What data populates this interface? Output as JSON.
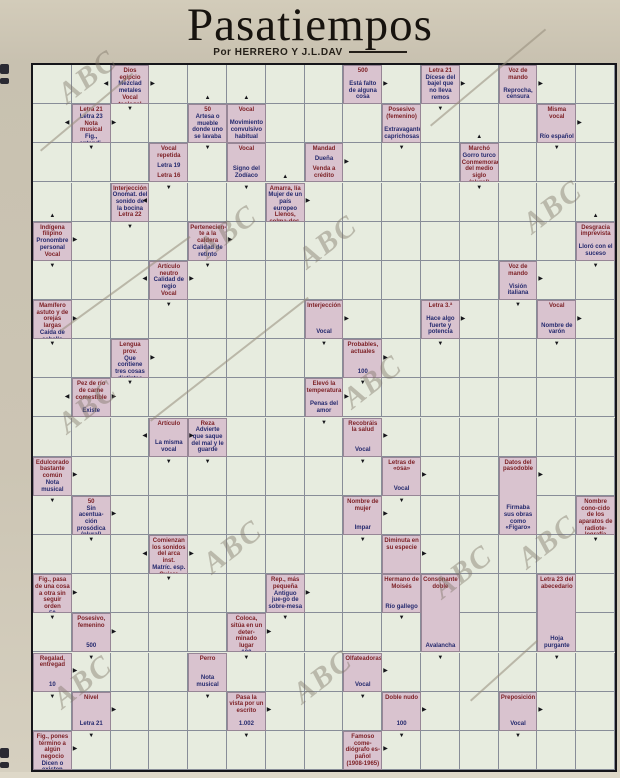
{
  "page": {
    "title": "Pasatiempos",
    "byline": "Por HERRERO Y J.L.DAV",
    "watermark_text": "ABC"
  },
  "colors": {
    "paper": "#cbc3b2",
    "board_bg": "#e7ecdf",
    "clue_bg": "#d9c3cf",
    "grid_line": "#3a405c",
    "clue_text_red": "#7c1f24",
    "clue_text_navy": "#252a6e",
    "arrow": "#15151a"
  },
  "grid": {
    "cols": 15,
    "rows": 18
  },
  "clues": [
    {
      "r": 0,
      "c": 2,
      "rs": 1,
      "text": "Dios egipcio|Mezclad metales|Vocal teologal"
    },
    {
      "r": 0,
      "c": 8,
      "rs": 1,
      "text": "500|Está falto de alguna cosa"
    },
    {
      "r": 0,
      "c": 10,
      "rs": 1,
      "text": "Letra 21|Dícese del bajel que no lleva remos"
    },
    {
      "r": 0,
      "c": 12,
      "rs": 1,
      "text": "Voz de mando|Reprocha, censura"
    },
    {
      "r": 1,
      "c": 1,
      "rs": 1,
      "text": "Letra 21|Letra 23|Nota musical|Fig., entendi-miento, seso"
    },
    {
      "r": 1,
      "c": 4,
      "rs": 1,
      "text": "50|Artesa o mueble donde uno se lavaba"
    },
    {
      "r": 1,
      "c": 5,
      "rs": 1,
      "text": "Vocal|Movimiento convulsivo habitual"
    },
    {
      "r": 1,
      "c": 9,
      "rs": 1,
      "text": "Posesivo (femenino)|Extravagantes, caprichosas"
    },
    {
      "r": 1,
      "c": 13,
      "rs": 1,
      "text": "Misma vocal|Río español"
    },
    {
      "r": 2,
      "c": 3,
      "rs": 1,
      "text": "Vocal repetida|Letra 19|Letra 16"
    },
    {
      "r": 2,
      "c": 5,
      "rs": 1,
      "text": "Vocal|Signo del Zodíaco"
    },
    {
      "r": 2,
      "c": 7,
      "rs": 1,
      "text": "Mandad|Dueña|Venda a crédito"
    },
    {
      "r": 2,
      "c": 11,
      "rs": 1,
      "text": "Marchó|Gorro turco|Conmemoración del medio siglo (plural)"
    },
    {
      "r": 3,
      "c": 2,
      "rs": 1,
      "text": "Interjección|Onomat. del sonido de la bocina|Letra 22"
    },
    {
      "r": 3,
      "c": 6,
      "rs": 1,
      "text": "Amarra, lía|Mujer de un país europeo|Llenos, colma-dos, totales"
    },
    {
      "r": 4,
      "c": 0,
      "rs": 1,
      "text": "Indígena filipino|Pronombre personal|Vocal"
    },
    {
      "r": 4,
      "c": 4,
      "rs": 1,
      "text": "Pertenecien-te a la caldera|Calidad de retinto"
    },
    {
      "r": 4,
      "c": 14,
      "rs": 1,
      "text": "Desgracia imprevista|Lloró con el suceso"
    },
    {
      "r": 5,
      "c": 3,
      "rs": 1,
      "text": "Artículo neutro|Calidad de regio|Vocal"
    },
    {
      "r": 5,
      "c": 12,
      "rs": 1,
      "text": "Voz de mando|Visión italiana"
    },
    {
      "r": 6,
      "c": 0,
      "rs": 1,
      "text": "Mamífero astuto y de orejas largas|Caída de cabello"
    },
    {
      "r": 6,
      "c": 7,
      "rs": 1,
      "text": "Interjección|Vocal"
    },
    {
      "r": 6,
      "c": 10,
      "rs": 1,
      "text": "Letra 3.ª|Hace algo fuerte y potencia"
    },
    {
      "r": 6,
      "c": 13,
      "rs": 1,
      "text": "Vocal|Nombre de varón"
    },
    {
      "r": 7,
      "c": 2,
      "rs": 1,
      "text": "Lengua prov.|Que contiene tres cosas distintas|Letra 2.ª"
    },
    {
      "r": 7,
      "c": 8,
      "rs": 1,
      "text": "Probables, actuales|100"
    },
    {
      "r": 8,
      "c": 1,
      "rs": 1,
      "text": "Pez de río de carne comestible|Existe"
    },
    {
      "r": 8,
      "c": 7,
      "rs": 1,
      "text": "Elevó la temperatura|Penas del amor"
    },
    {
      "r": 9,
      "c": 3,
      "rs": 1,
      "text": "Artículo|La misma vocal"
    },
    {
      "r": 9,
      "c": 4,
      "rs": 1,
      "text": "Reza|Advierte que saque del mal y le guarde"
    },
    {
      "r": 9,
      "c": 8,
      "rs": 1,
      "text": "Recobráis la salud|Vocal"
    },
    {
      "r": 10,
      "c": 0,
      "rs": 1,
      "text": "Edulcorado bastante común|Nota musical"
    },
    {
      "r": 10,
      "c": 9,
      "rs": 1,
      "text": "Letras de «osa»|Vocal"
    },
    {
      "r": 10,
      "c": 12,
      "rs": 2,
      "text": "Datos del pasodoble|Firmaba sus obras como «Fígaro»"
    },
    {
      "r": 11,
      "c": 1,
      "rs": 1,
      "text": "50|Sin acentua-ción prosódica (plural)|Matríc. esp."
    },
    {
      "r": 11,
      "c": 8,
      "rs": 1,
      "text": "Nombre de mujer|Impar"
    },
    {
      "r": 11,
      "c": 14,
      "rs": 1,
      "text": "Nombre cono-cido de los aparatos de radiote-legrafía"
    },
    {
      "r": 12,
      "c": 3,
      "rs": 1,
      "text": "Comienzan los sonidos del arca inst.|Matríc. esp.|Quiere"
    },
    {
      "r": 12,
      "c": 9,
      "rs": 1,
      "text": "Diminuta en su especie"
    },
    {
      "r": 13,
      "c": 0,
      "rs": 1,
      "text": "Fig., pasa de una cosa a otra sin seguir orden|50"
    },
    {
      "r": 13,
      "c": 6,
      "rs": 1,
      "text": "Rep., más pequeña|Antiguo jue-go de sobre-mesa"
    },
    {
      "r": 13,
      "c": 9,
      "rs": 1,
      "text": "Hermano de Moisés|Río gallego"
    },
    {
      "r": 13,
      "c": 10,
      "rs": 2,
      "text": "Consonante doble|Avalancha"
    },
    {
      "r": 13,
      "c": 13,
      "rs": 2,
      "text": "Letra 23 del abecedario|Hoja purgante"
    },
    {
      "r": 14,
      "c": 1,
      "rs": 1,
      "text": "Posesivo, femenino|500"
    },
    {
      "r": 14,
      "c": 5,
      "rs": 1,
      "text": "Coloca, sitúa en un deter-minado lugar|100"
    },
    {
      "r": 15,
      "c": 0,
      "rs": 1,
      "text": "Regalad, entregad|10"
    },
    {
      "r": 15,
      "c": 4,
      "rs": 1,
      "text": "Perro|Nota musical"
    },
    {
      "r": 15,
      "c": 8,
      "rs": 1,
      "text": "Olfateadoras|Vocal"
    },
    {
      "r": 16,
      "c": 1,
      "rs": 1,
      "text": "Nivel|Letra 21"
    },
    {
      "r": 16,
      "c": 5,
      "rs": 1,
      "text": "Pasa la vista por un escrito|1.002"
    },
    {
      "r": 16,
      "c": 9,
      "rs": 1,
      "text": "Doble nudo|100"
    },
    {
      "r": 16,
      "c": 12,
      "rs": 1,
      "text": "Preposición|Vocal"
    },
    {
      "r": 17,
      "c": 0,
      "rs": 1,
      "text": "Fig., pones término a algún negocio|Dicen o existen"
    },
    {
      "r": 17,
      "c": 8,
      "rs": 1,
      "text": "Famoso come-diógrafo es-pañol (1908-1965)"
    }
  ],
  "arrows": [
    [
      0,
      1,
      "L"
    ],
    [
      0,
      3,
      "R"
    ],
    [
      0,
      4,
      "U"
    ],
    [
      0,
      5,
      "U"
    ],
    [
      0,
      9,
      "R"
    ],
    [
      0,
      11,
      "R"
    ],
    [
      0,
      13,
      "R"
    ],
    [
      1,
      0,
      "L"
    ],
    [
      1,
      2,
      "R"
    ],
    [
      1,
      2,
      "D"
    ],
    [
      1,
      10,
      "D"
    ],
    [
      1,
      11,
      "U"
    ],
    [
      1,
      14,
      "R"
    ],
    [
      2,
      1,
      "D"
    ],
    [
      2,
      4,
      "D"
    ],
    [
      2,
      6,
      "U"
    ],
    [
      2,
      8,
      "R"
    ],
    [
      2,
      9,
      "D"
    ],
    [
      2,
      13,
      "D"
    ],
    [
      3,
      0,
      "U"
    ],
    [
      3,
      2,
      "L"
    ],
    [
      3,
      3,
      "D"
    ],
    [
      3,
      5,
      "D"
    ],
    [
      3,
      7,
      "R"
    ],
    [
      3,
      11,
      "D"
    ],
    [
      3,
      14,
      "U"
    ],
    [
      4,
      1,
      "R"
    ],
    [
      4,
      2,
      "D"
    ],
    [
      4,
      5,
      "R"
    ],
    [
      5,
      0,
      "D"
    ],
    [
      5,
      2,
      "L"
    ],
    [
      5,
      4,
      "R"
    ],
    [
      5,
      4,
      "D"
    ],
    [
      5,
      13,
      "R"
    ],
    [
      5,
      14,
      "D"
    ],
    [
      6,
      1,
      "R"
    ],
    [
      6,
      3,
      "D"
    ],
    [
      6,
      8,
      "R"
    ],
    [
      6,
      11,
      "R"
    ],
    [
      6,
      12,
      "D"
    ],
    [
      6,
      14,
      "R"
    ],
    [
      7,
      0,
      "D"
    ],
    [
      7,
      3,
      "R"
    ],
    [
      7,
      7,
      "D"
    ],
    [
      7,
      9,
      "R"
    ],
    [
      7,
      10,
      "D"
    ],
    [
      7,
      13,
      "D"
    ],
    [
      8,
      0,
      "L"
    ],
    [
      8,
      2,
      "R"
    ],
    [
      8,
      2,
      "D"
    ],
    [
      8,
      8,
      "R"
    ],
    [
      8,
      8,
      "D"
    ],
    [
      9,
      2,
      "L"
    ],
    [
      9,
      4,
      "R"
    ],
    [
      9,
      7,
      "D"
    ],
    [
      9,
      9,
      "R"
    ],
    [
      10,
      1,
      "R"
    ],
    [
      10,
      3,
      "D"
    ],
    [
      10,
      4,
      "D"
    ],
    [
      10,
      8,
      "D"
    ],
    [
      10,
      10,
      "R"
    ],
    [
      10,
      13,
      "R"
    ],
    [
      11,
      0,
      "D"
    ],
    [
      11,
      2,
      "R"
    ],
    [
      11,
      9,
      "R"
    ],
    [
      11,
      9,
      "D"
    ],
    [
      12,
      1,
      "D"
    ],
    [
      12,
      2,
      "L"
    ],
    [
      12,
      4,
      "R"
    ],
    [
      12,
      8,
      "D"
    ],
    [
      12,
      10,
      "R"
    ],
    [
      12,
      14,
      "D"
    ],
    [
      13,
      1,
      "R"
    ],
    [
      13,
      3,
      "D"
    ],
    [
      13,
      7,
      "R"
    ],
    [
      14,
      0,
      "D"
    ],
    [
      14,
      2,
      "R"
    ],
    [
      14,
      6,
      "R"
    ],
    [
      14,
      6,
      "D"
    ],
    [
      14,
      9,
      "D"
    ],
    [
      15,
      1,
      "R"
    ],
    [
      15,
      1,
      "D"
    ],
    [
      15,
      5,
      "D"
    ],
    [
      15,
      9,
      "R"
    ],
    [
      15,
      10,
      "D"
    ],
    [
      15,
      13,
      "D"
    ],
    [
      16,
      0,
      "D"
    ],
    [
      16,
      2,
      "R"
    ],
    [
      16,
      4,
      "D"
    ],
    [
      16,
      6,
      "R"
    ],
    [
      16,
      8,
      "D"
    ],
    [
      16,
      10,
      "R"
    ],
    [
      16,
      13,
      "R"
    ],
    [
      17,
      1,
      "R"
    ],
    [
      17,
      1,
      "D"
    ],
    [
      17,
      5,
      "D"
    ],
    [
      17,
      9,
      "R"
    ],
    [
      17,
      9,
      "D"
    ],
    [
      17,
      12,
      "D"
    ]
  ],
  "watermarks": [
    {
      "x": 55,
      "y": 60
    },
    {
      "x": 195,
      "y": 215
    },
    {
      "x": 520,
      "y": 190
    },
    {
      "x": 295,
      "y": 225
    },
    {
      "x": 340,
      "y": 365
    },
    {
      "x": 55,
      "y": 390
    },
    {
      "x": 200,
      "y": 530
    },
    {
      "x": 515,
      "y": 525
    },
    {
      "x": 50,
      "y": 665
    },
    {
      "x": 290,
      "y": 660
    },
    {
      "x": 430,
      "y": 555
    }
  ],
  "scratches": [
    {
      "x": 40,
      "y": 150,
      "len": 120,
      "deg": -40
    },
    {
      "x": 430,
      "y": 125,
      "len": 150,
      "deg": -40
    },
    {
      "x": 150,
      "y": 420,
      "len": 200,
      "deg": -38
    },
    {
      "x": 470,
      "y": 700,
      "len": 90,
      "deg": -42
    },
    {
      "x": 60,
      "y": 330,
      "len": 160,
      "deg": -36
    }
  ]
}
